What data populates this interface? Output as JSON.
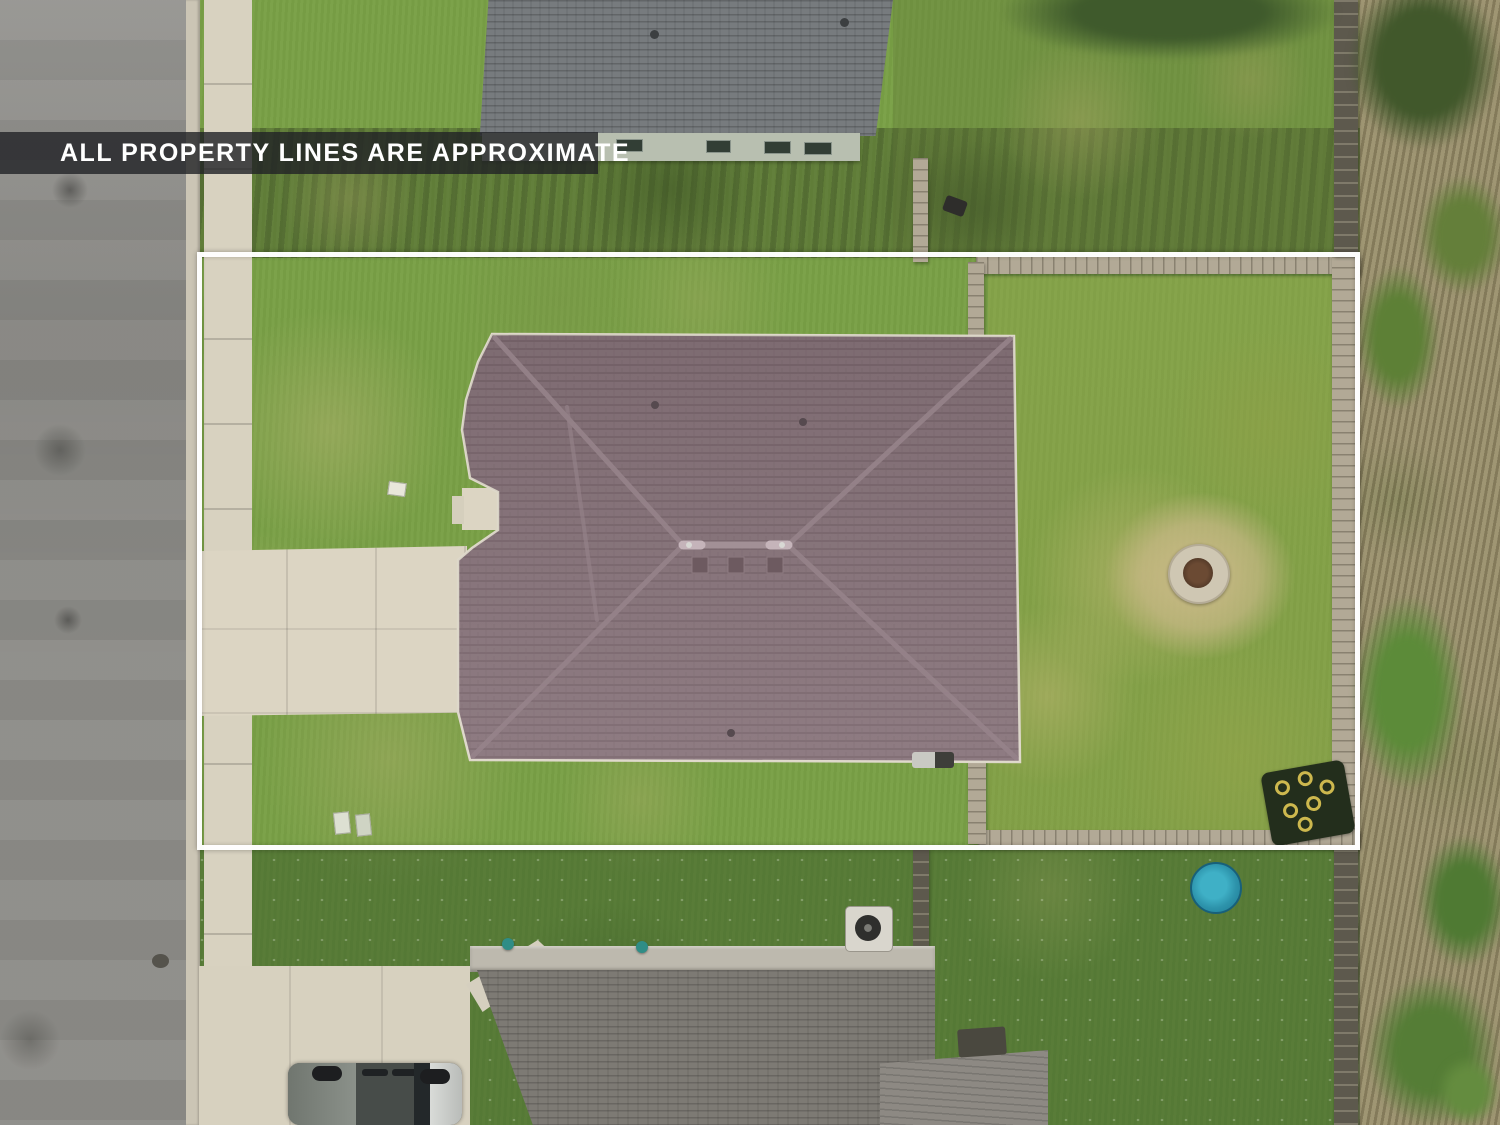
{
  "banner": {
    "text": "ALL PROPERTY LINES ARE APPROXIMATE"
  },
  "scene": {
    "kind": "top-down aerial drone photo of a residential lot",
    "overlay": "white rectangular approximate property boundary",
    "objects": [
      "asphalt street along left edge",
      "concrete sidewalk beside street",
      "subject house with mauve-brown hip roof",
      "concrete driveway from street to garage",
      "fenced backyard with stone fire pit on gravel patch",
      "dark play mat with yellow rings in backyard corner",
      "wood privacy fence around backyard and along right side",
      "wild brush and trees beyond right fence",
      "neighbor house with gray roof at top",
      "neighbor house with gray roof at bottom",
      "blue round kiddie pool in bottom neighbor yard",
      "pickup truck parked on bottom neighbor driveway",
      "air-conditioner units beside houses",
      "manhole cover at street edge"
    ]
  },
  "palette": {
    "property_line": "#ffffff",
    "banner_bg": "#222226",
    "banner_text": "#ffffff",
    "grass_green": "#79a046",
    "grass_dry": "#a8a866",
    "subject_roof": "#87737a",
    "neighbor_roof": "#797d80",
    "concrete": "#d9d3c2",
    "asphalt": "#8d8c88",
    "fence_wood": "#b2a996",
    "pool_blue": "#2d93ab",
    "firepit_gravel": "#cdbb8a"
  }
}
